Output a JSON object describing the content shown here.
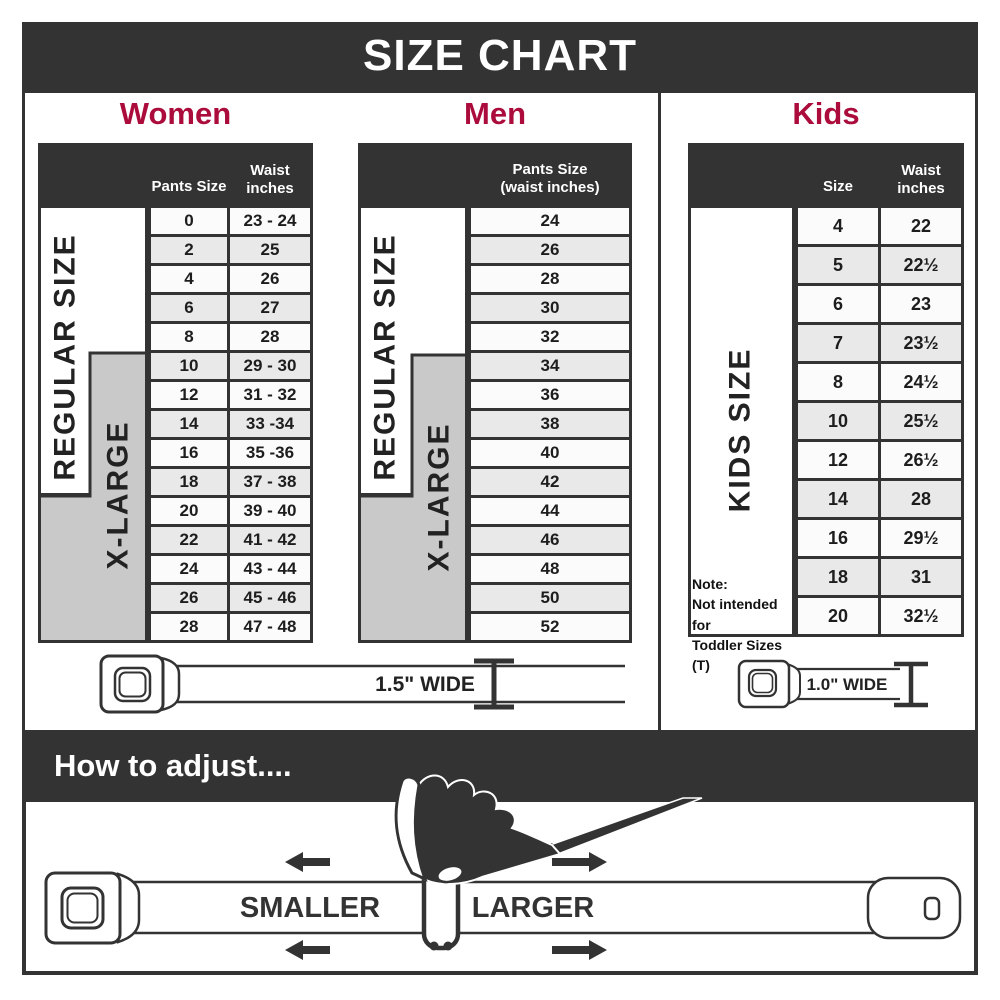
{
  "title": "SIZE CHART",
  "colors": {
    "accent_red": "#AB0C3B",
    "dark": "#333333",
    "xlarge_gray": "#C9C9C9",
    "row_light": "#FBFBFB",
    "row_shaded": "#E9E9E9"
  },
  "sections": {
    "women": {
      "label": "Women",
      "header": {
        "col1": "Pants Size",
        "col2_line1": "Waist",
        "col2_line2": "inches"
      },
      "regular_label": "REGULAR SIZE",
      "xlarge_label": "X-LARGE",
      "rows": [
        {
          "size": "0",
          "waist": "23 - 24"
        },
        {
          "size": "2",
          "waist": "25"
        },
        {
          "size": "4",
          "waist": "26"
        },
        {
          "size": "6",
          "waist": "27"
        },
        {
          "size": "8",
          "waist": "28"
        },
        {
          "size": "10",
          "waist": "29 - 30"
        },
        {
          "size": "12",
          "waist": "31 - 32"
        },
        {
          "size": "14",
          "waist": "33 -34"
        },
        {
          "size": "16",
          "waist": "35 -36"
        },
        {
          "size": "18",
          "waist": "37 - 38"
        },
        {
          "size": "20",
          "waist": "39 - 40"
        },
        {
          "size": "22",
          "waist": "41 - 42"
        },
        {
          "size": "24",
          "waist": "43 - 44"
        },
        {
          "size": "26",
          "waist": "45 - 46"
        },
        {
          "size": "28",
          "waist": "47 - 48"
        }
      ]
    },
    "men": {
      "label": "Men",
      "header_line1": "Pants Size",
      "header_line2": "(waist inches)",
      "regular_label": "REGULAR SIZE",
      "xlarge_label": "X-LARGE",
      "rows": [
        "24",
        "26",
        "28",
        "30",
        "32",
        "34",
        "36",
        "38",
        "40",
        "42",
        "44",
        "46",
        "48",
        "50",
        "52"
      ]
    },
    "kids": {
      "label": "Kids",
      "header": {
        "col1": "Size",
        "col2_line1": "Waist",
        "col2_line2": "inches"
      },
      "size_label": "KIDS SIZE",
      "note_line1": "Note:",
      "note_line2": "Not intended for",
      "note_line3": "Toddler Sizes (T)",
      "rows": [
        {
          "size": "4",
          "waist": "22"
        },
        {
          "size": "5",
          "waist": "22½"
        },
        {
          "size": "6",
          "waist": "23"
        },
        {
          "size": "7",
          "waist": "23½"
        },
        {
          "size": "8",
          "waist": "24½"
        },
        {
          "size": "10",
          "waist": "25½"
        },
        {
          "size": "12",
          "waist": "26½"
        },
        {
          "size": "14",
          "waist": "28"
        },
        {
          "size": "16",
          "waist": "29½"
        },
        {
          "size": "18",
          "waist": "31"
        },
        {
          "size": "20",
          "waist": "32½"
        }
      ]
    }
  },
  "belts": {
    "adult_width": "1.5\" WIDE",
    "kids_width": "1.0\" WIDE"
  },
  "adjust": {
    "heading": "How to adjust....",
    "smaller": "SMALLER",
    "larger": "LARGER"
  }
}
